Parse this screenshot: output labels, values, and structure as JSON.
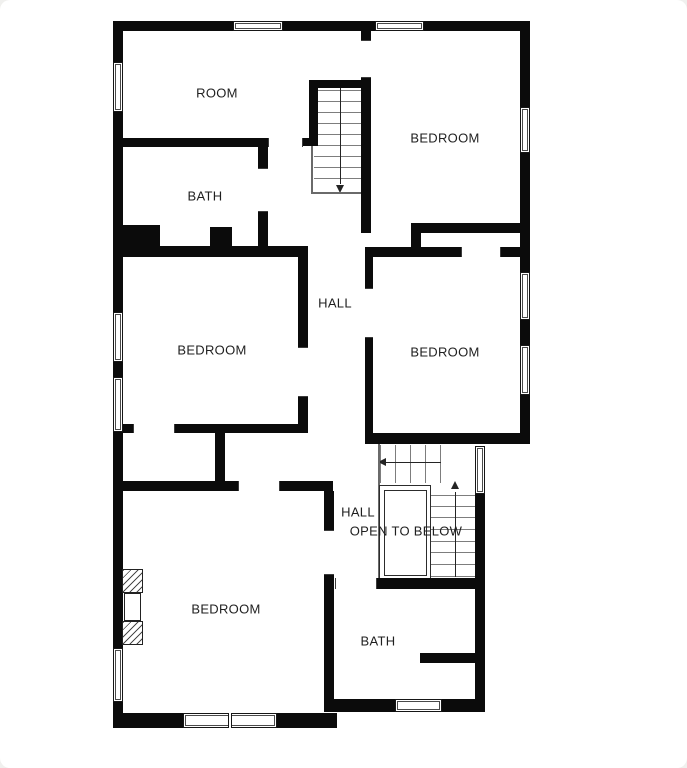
{
  "page": {
    "width": 687,
    "height": 768,
    "card_radius": 10
  },
  "colors": {
    "wall": "#0b0b0b",
    "stair_line": "#7d7d7d",
    "direction_line": "#242424",
    "text": "#1f1f1f",
    "background": "#ffffff",
    "page_background": "#f0f0ee"
  },
  "rooms": [
    {
      "name": "room",
      "label": "ROOM",
      "x": 217,
      "y": 93
    },
    {
      "name": "bath-upper",
      "label": "BATH",
      "x": 205,
      "y": 196
    },
    {
      "name": "hall-upper",
      "label": "HALL",
      "x": 335,
      "y": 303
    },
    {
      "name": "bedroom-top-right",
      "label": "BEDROOM",
      "x": 445,
      "y": 138
    },
    {
      "name": "bedroom-mid-right",
      "label": "BEDROOM",
      "x": 445,
      "y": 352
    },
    {
      "name": "bedroom-mid-left",
      "label": "BEDROOM",
      "x": 212,
      "y": 350
    },
    {
      "name": "bedroom-bottom-left",
      "label": "BEDROOM",
      "x": 226,
      "y": 609
    },
    {
      "name": "hall-lower",
      "label": "HALL",
      "x": 358,
      "y": 512
    },
    {
      "name": "open-to-below",
      "label": "OPEN TO BELOW",
      "x": 406,
      "y": 531
    },
    {
      "name": "bath-lower",
      "label": "BATH",
      "x": 378,
      "y": 641
    }
  ],
  "walls": [
    [
      113,
      21,
      120,
      10
    ],
    [
      283,
      21,
      92,
      10
    ],
    [
      424,
      21,
      106,
      10
    ],
    [
      113,
      21,
      10,
      41
    ],
    [
      113,
      112,
      10,
      200
    ],
    [
      113,
      362,
      10,
      15
    ],
    [
      113,
      432,
      10,
      216
    ],
    [
      113,
      702,
      10,
      26
    ],
    [
      520,
      21,
      10,
      86
    ],
    [
      520,
      153,
      10,
      119
    ],
    [
      520,
      320,
      10,
      25
    ],
    [
      520,
      395,
      10,
      48
    ],
    [
      113,
      713,
      70,
      15
    ],
    [
      277,
      713,
      60,
      15
    ],
    [
      325,
      699,
      70,
      13
    ],
    [
      442,
      699,
      43,
      13
    ],
    [
      475,
      494,
      10,
      218
    ],
    [
      365,
      433,
      165,
      11
    ],
    [
      113,
      138,
      155,
      9
    ],
    [
      303,
      138,
      15,
      8
    ],
    [
      309,
      80,
      9,
      65
    ],
    [
      309,
      80,
      58,
      8
    ],
    [
      361,
      78,
      10,
      155
    ],
    [
      361,
      30,
      10,
      11
    ],
    [
      411,
      223,
      119,
      10
    ],
    [
      411,
      233,
      10,
      14
    ],
    [
      365,
      247,
      96,
      10
    ],
    [
      501,
      247,
      19,
      10
    ],
    [
      365,
      257,
      8,
      31
    ],
    [
      365,
      338,
      8,
      95
    ],
    [
      258,
      147,
      10,
      21
    ],
    [
      258,
      212,
      10,
      34
    ],
    [
      113,
      246,
      195,
      11
    ],
    [
      123,
      225,
      37,
      21
    ],
    [
      210,
      227,
      22,
      19
    ],
    [
      298,
      257,
      10,
      90
    ],
    [
      298,
      397,
      10,
      36
    ],
    [
      175,
      424,
      128,
      9
    ],
    [
      123,
      424,
      10,
      9
    ],
    [
      215,
      433,
      10,
      48
    ],
    [
      113,
      481,
      125,
      10
    ],
    [
      280,
      481,
      53,
      10
    ],
    [
      324,
      491,
      10,
      39
    ],
    [
      324,
      575,
      10,
      137
    ],
    [
      377,
      578,
      100,
      11
    ],
    [
      420,
      653,
      57,
      10
    ]
  ],
  "windows": [
    {
      "rect": [
        113,
        62,
        10,
        50
      ],
      "orient": "v"
    },
    {
      "rect": [
        113,
        312,
        10,
        50
      ],
      "orient": "v"
    },
    {
      "rect": [
        113,
        377,
        10,
        55
      ],
      "orient": "v"
    },
    {
      "rect": [
        113,
        648,
        10,
        54
      ],
      "orient": "v"
    },
    {
      "rect": [
        520,
        107,
        10,
        46
      ],
      "orient": "v"
    },
    {
      "rect": [
        520,
        272,
        10,
        48
      ],
      "orient": "v"
    },
    {
      "rect": [
        520,
        345,
        10,
        50
      ],
      "orient": "v"
    },
    {
      "rect": [
        475,
        446,
        10,
        48
      ],
      "orient": "v"
    },
    {
      "rect": [
        233,
        21,
        50,
        10
      ],
      "orient": "h"
    },
    {
      "rect": [
        375,
        21,
        49,
        10
      ],
      "orient": "h"
    },
    {
      "rect": [
        183,
        713,
        94,
        15
      ],
      "orient": "h",
      "divider": true
    },
    {
      "rect": [
        395,
        699,
        47,
        13
      ],
      "orient": "h"
    }
  ],
  "openings": [
    {
      "rect": [
        268,
        138,
        35,
        9
      ],
      "orient": "h"
    },
    {
      "rect": [
        361,
        40,
        10,
        38
      ],
      "orient": "v"
    },
    {
      "rect": [
        258,
        168,
        10,
        44
      ],
      "orient": "v"
    },
    {
      "rect": [
        298,
        347,
        10,
        50
      ],
      "orient": "v"
    },
    {
      "rect": [
        365,
        288,
        8,
        50
      ],
      "orient": "v"
    },
    {
      "rect": [
        461,
        247,
        40,
        10
      ],
      "orient": "h"
    },
    {
      "rect": [
        133,
        424,
        42,
        9
      ],
      "orient": "h"
    },
    {
      "rect": [
        238,
        481,
        42,
        10
      ],
      "orient": "h"
    },
    {
      "rect": [
        324,
        530,
        10,
        45
      ],
      "orient": "v"
    },
    {
      "rect": [
        335,
        578,
        42,
        11
      ],
      "orient": "h"
    }
  ],
  "stair_top": {
    "treads_y": [
      90,
      101,
      112,
      123,
      134,
      145,
      156,
      167,
      178
    ],
    "tread_x1": 314,
    "tread_x2": 361,
    "center": {
      "x": 340,
      "y1": 88,
      "y2": 184
    },
    "arrow": {
      "x": 340,
      "y": 185,
      "dir": "down"
    },
    "rail": [
      311,
      145,
      2,
      49
    ],
    "bottom_line": [
      311,
      192,
      51,
      2
    ]
  },
  "stair_lower": {
    "run_h": {
      "tread_xs": [
        380,
        395,
        410,
        425,
        440
      ],
      "y1": 445,
      "y2": 483,
      "center": {
        "y": 462,
        "x1": 385,
        "x2": 441
      },
      "arrow": {
        "x": 382,
        "y": 462,
        "dir": "left"
      }
    },
    "run_v": {
      "tread_ys": [
        495,
        506,
        517,
        529,
        541,
        552,
        564,
        576
      ],
      "x1": 431,
      "x2": 475,
      "center": {
        "x": 455,
        "y1": 492,
        "y2": 577
      },
      "arrow": {
        "x": 455,
        "y": 485,
        "dir": "up"
      }
    },
    "rail": [
      378,
      444,
      2,
      136
    ],
    "open_below": {
      "outer": [
        379,
        485,
        52,
        95
      ],
      "inner": [
        384,
        490,
        43,
        86
      ]
    }
  },
  "fireplace": {
    "hatch_top": [
      122,
      569,
      21,
      24
    ],
    "firebox": [
      124,
      593,
      17,
      28
    ],
    "hatch_bottom": [
      122,
      621,
      21,
      24
    ]
  }
}
